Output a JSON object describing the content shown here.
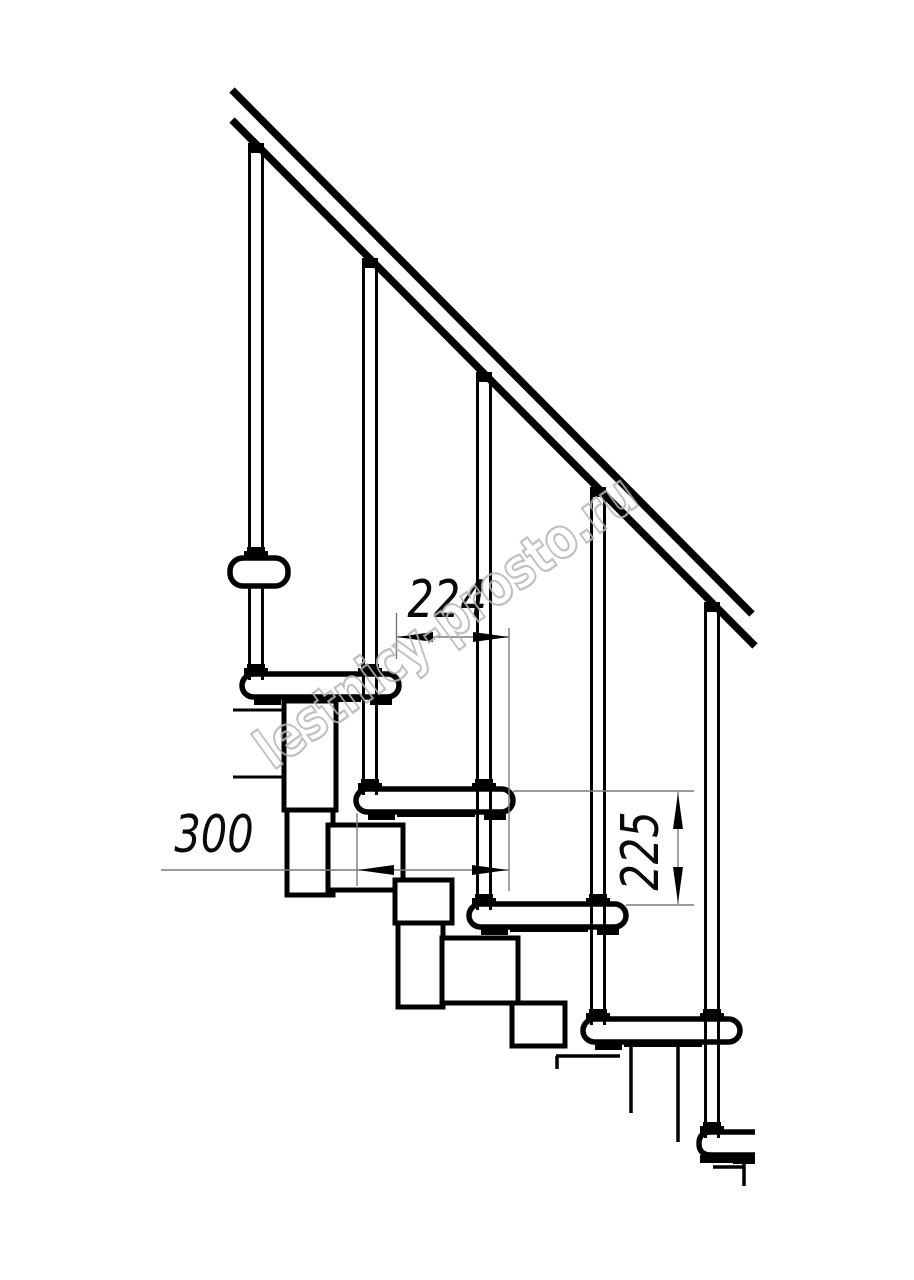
{
  "page": {
    "background": "#ffffff"
  },
  "drawing": {
    "subject": "modular staircase side elevation",
    "line_color": "#000000",
    "dimension_line_color": "#7a7a7a",
    "tread_count": 5,
    "baluster_count": 5
  },
  "dimensions": {
    "step_run": {
      "value": "224",
      "orientation": "horizontal"
    },
    "tread_depth": {
      "value": "300",
      "orientation": "horizontal"
    },
    "step_rise": {
      "value": "225",
      "orientation": "vertical"
    }
  },
  "watermark": {
    "text": "lestnicy-prosto.ru",
    "color": "#b6b6b6"
  }
}
